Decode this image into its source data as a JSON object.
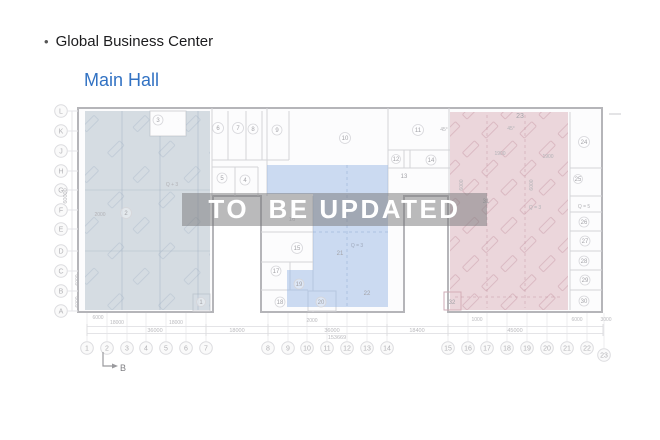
{
  "header": {
    "bullet": "•",
    "title": "Global Business Center",
    "subtitle": "Main Hall"
  },
  "watermark": "TO  BE UPDATED",
  "axis": {
    "rows": [
      "L",
      "K",
      "J",
      "H",
      "G",
      "F",
      "E",
      "D",
      "C",
      "B",
      "A"
    ],
    "cols": [
      "1",
      "2",
      "3",
      "4",
      "5",
      "6",
      "7",
      "8",
      "9",
      "10",
      "11",
      "12",
      "13",
      "14",
      "15",
      "16",
      "17",
      "18",
      "19",
      "20",
      "21",
      "22",
      "23"
    ]
  },
  "rooms": [
    "1",
    "2",
    "3",
    "4",
    "5",
    "6",
    "7",
    "8",
    "9",
    "10",
    "11",
    "12",
    "13",
    "14",
    "15",
    "16",
    "17",
    "18",
    "19",
    "20",
    "21",
    "22",
    "23",
    "24",
    "25",
    "26",
    "27",
    "28",
    "29",
    "30",
    "31",
    "32"
  ],
  "annotations": {
    "q_plus_3": "Q + 3",
    "q_eq_3": "Q = 3",
    "q_eq_5": "Q = 5",
    "angle": "45°",
    "section_marker": "B"
  },
  "dimensions": {
    "top_row": [
      "6000",
      "18000",
      "18000",
      "2000",
      "1000",
      "6000",
      "3000"
    ],
    "mid_row": [
      "36000",
      "18000",
      "36000",
      "18400",
      "45000"
    ],
    "total": "153669",
    "vertical": [
      "60000",
      "6000",
      "6000"
    ],
    "inner": [
      "2000",
      "1900",
      "1900",
      "6000",
      "6000"
    ]
  },
  "colors": {
    "subtitle_blue": "#3272c3",
    "overlay_left": "#adbbc7",
    "overlay_middle": "#99b7e5",
    "overlay_right": "#d9afb9",
    "watermark_band": "rgba(122,122,124,0.52)",
    "watermark_text": "#ffffff"
  }
}
